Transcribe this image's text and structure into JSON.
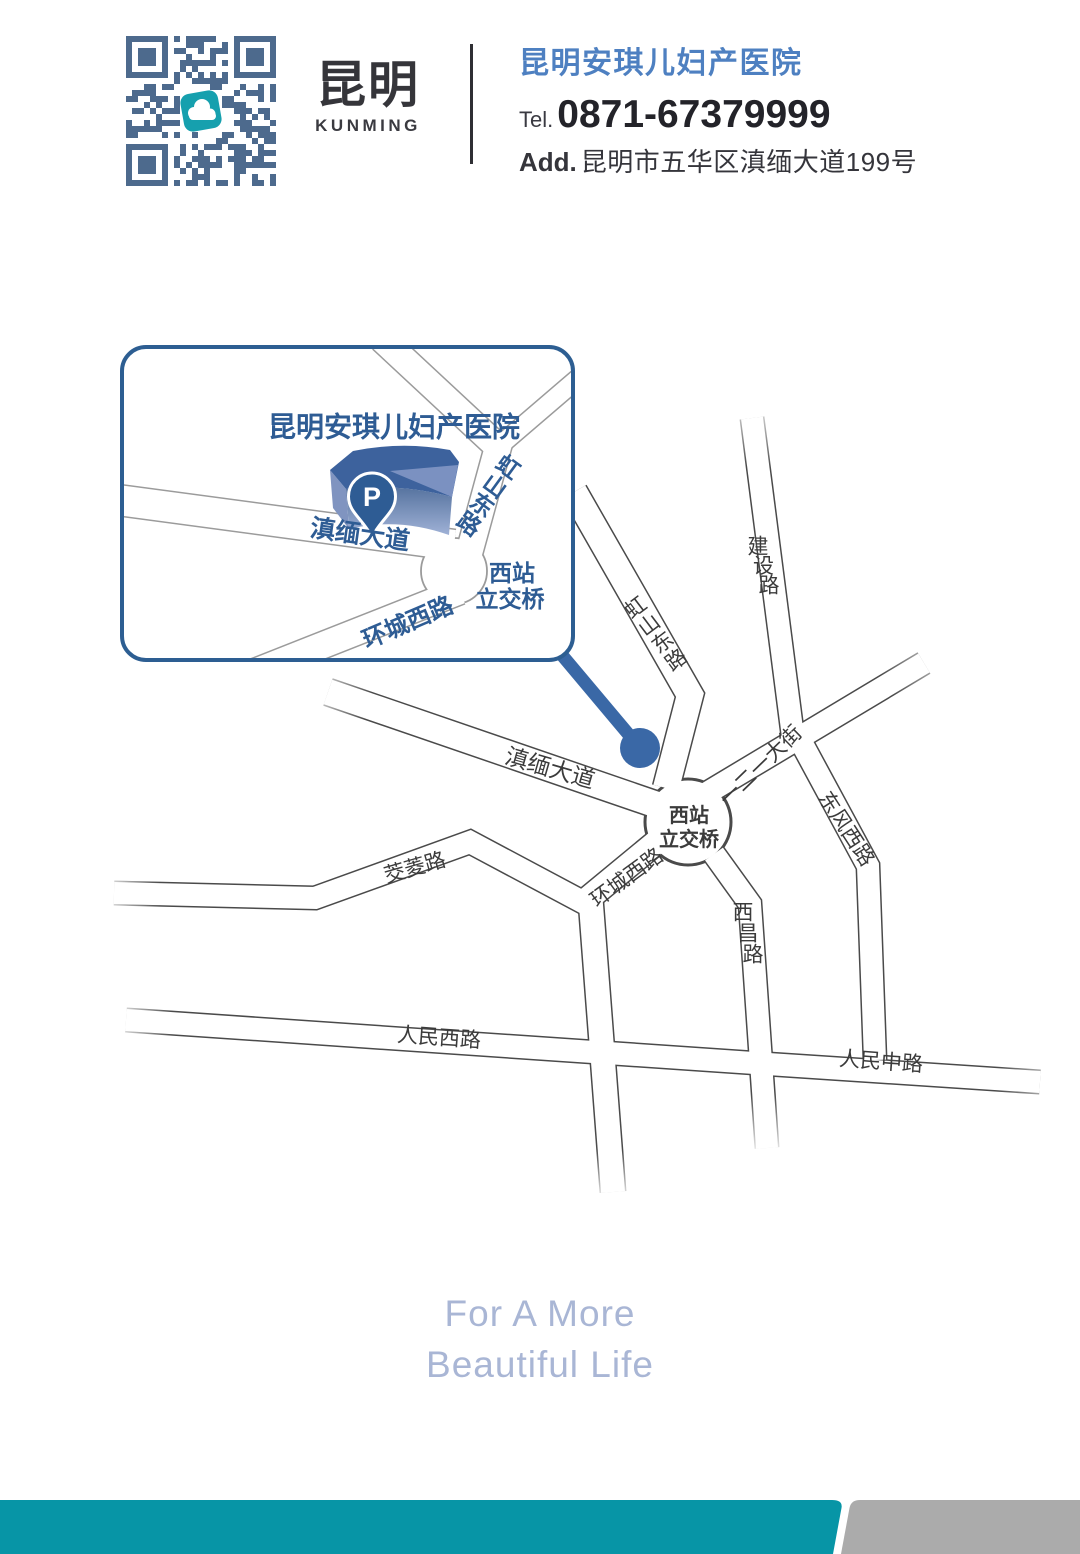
{
  "header": {
    "brand_cn": "昆明",
    "brand_en": "KUNMING",
    "hospital_name": "昆明安琪儿妇产医院",
    "tel_label": "Tel.",
    "tel_number": "0871-67379999",
    "add_label": "Add.",
    "address": "昆明市五华区滇缅大道199号",
    "qr_icon": "cloud-logo"
  },
  "inset": {
    "labels": [
      {
        "id": "inset-title",
        "text": "昆明安琪儿妇产医院",
        "x": 148,
        "y": 82,
        "rot": 0,
        "size": 28,
        "weight": 700,
        "color": "#2e5c94",
        "anchor": "start"
      },
      {
        "id": "inset-road-label-dianmian",
        "text": "滇缅大道",
        "x": 240,
        "y": 190,
        "rot": 8,
        "size": 25,
        "weight": 700,
        "color": "#2e5c94"
      },
      {
        "id": "inset-road-label-hongshan",
        "text": "虹山东路",
        "mode": "vstack",
        "x": 388,
        "y": 122,
        "dx": -13,
        "dy": 19,
        "rot": 36,
        "size": 23,
        "weight": 700,
        "color": "#2e5c94"
      },
      {
        "id": "inset-junction-label-1",
        "text": "西站",
        "x": 392,
        "y": 228,
        "rot": 0,
        "size": 23,
        "weight": 700,
        "color": "#2e5c94"
      },
      {
        "id": "inset-junction-label-2",
        "text": "立交桥",
        "x": 390,
        "y": 254,
        "rot": 0,
        "size": 23,
        "weight": 700,
        "color": "#2e5c94"
      },
      {
        "id": "inset-road-label-huancheng",
        "text": "环城西路",
        "x": 288,
        "y": 278,
        "rot": -23,
        "size": 24,
        "weight": 700,
        "color": "#2e5c94"
      },
      {
        "id": "parking-label",
        "text": "P",
        "x": 252,
        "y": 152,
        "rot": 0,
        "size": 27,
        "weight": 700,
        "color": "#ffffff"
      }
    ]
  },
  "map": {
    "labels": [
      {
        "id": "road-label-dianmian",
        "text": "滇缅大道",
        "x": 550,
        "y": 388,
        "rot": 16,
        "size": 23,
        "weight": 500,
        "color": "#3b3b3b"
      },
      {
        "id": "road-label-hongshan",
        "text": "虹山东路",
        "mode": "vstack",
        "x": 636,
        "y": 228,
        "dx": 13.5,
        "dy": 17.5,
        "rot": -37,
        "size": 21,
        "weight": 500,
        "color": "#3b3b3b"
      },
      {
        "id": "road-label-jianshe",
        "text": "建设路",
        "mode": "vstack",
        "x": 758,
        "y": 167,
        "dx": 5.5,
        "dy": 19.5,
        "rot": 0,
        "size": 21,
        "weight": 500,
        "color": "#3b3b3b"
      },
      {
        "id": "road-label-yieryi",
        "text": "一二一大街",
        "x": 761,
        "y": 386,
        "rot": -44,
        "size": 21,
        "weight": 500,
        "color": "#3b3b3b"
      },
      {
        "id": "road-label-dongfeng",
        "text": "东风西路",
        "x": 846,
        "y": 449,
        "rot": 57,
        "size": 21,
        "weight": 500,
        "color": "#3b3b3b"
      },
      {
        "id": "junction-label-1",
        "text": "西站",
        "x": 689,
        "y": 436,
        "rot": 0,
        "size": 20,
        "weight": 600,
        "color": "#3b3b3b"
      },
      {
        "id": "junction-label-2",
        "text": "立交桥",
        "x": 689,
        "y": 460,
        "rot": 0,
        "size": 20,
        "weight": 600,
        "color": "#3b3b3b"
      },
      {
        "id": "road-label-huancheng",
        "text": "环城西路",
        "x": 627,
        "y": 498,
        "rot": -36,
        "size": 21,
        "weight": 500,
        "color": "#3b3b3b"
      },
      {
        "id": "road-label-jiaoling",
        "text": "茭菱路",
        "x": 415,
        "y": 488,
        "rot": -16,
        "size": 21,
        "weight": 500,
        "color": "#3b3b3b"
      },
      {
        "id": "road-label-renminxi",
        "text": "人民西路",
        "x": 439,
        "y": 658,
        "rot": 4,
        "size": 21,
        "weight": 500,
        "color": "#3b3b3b"
      },
      {
        "id": "road-label-renminzhong",
        "text": "人民中路",
        "x": 881,
        "y": 682,
        "rot": 4,
        "size": 21,
        "weight": 500,
        "color": "#3b3b3b"
      },
      {
        "id": "road-label-xichang",
        "text": "西昌路",
        "mode": "vstack",
        "x": 743,
        "y": 533,
        "dx": 5,
        "dy": 21,
        "rot": 0,
        "size": 21,
        "weight": 500,
        "color": "#3b3b3b"
      }
    ]
  },
  "slogan": {
    "line1": "For A More",
    "line2": "Beautiful Life"
  },
  "colors": {
    "hospital_name_blue": "#4e80c1",
    "inset_blue": "#2e5c94",
    "inset_border": "#2d5e92",
    "marker_blue": "#3a68a6",
    "building_top": "#3d629d",
    "footer_teal": "#0795a6",
    "footer_gray": "#ababab",
    "slogan_blue": "#a9b6d5",
    "qr_blue": "#4d6a8d",
    "qr_center_teal": "#16a0ae"
  }
}
